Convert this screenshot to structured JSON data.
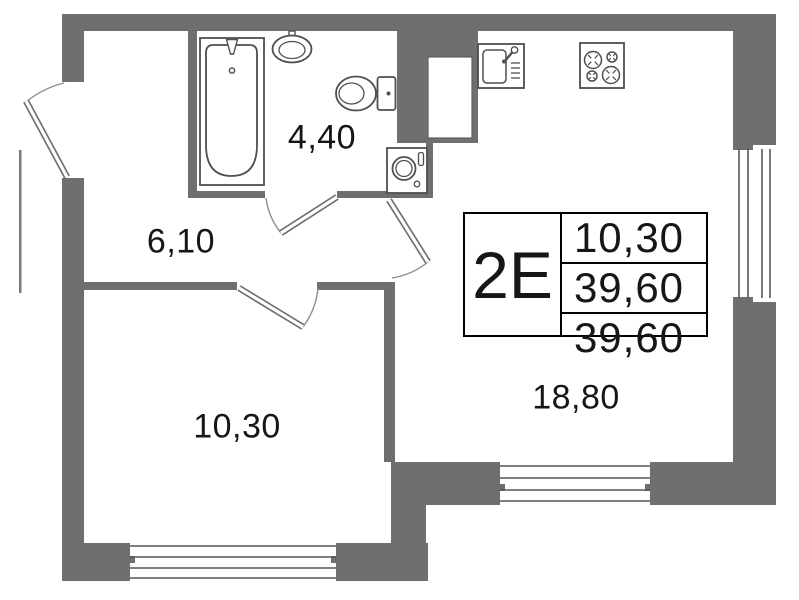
{
  "rooms": {
    "bathroom": {
      "area": "4,40"
    },
    "hallway": {
      "area": "6,10"
    },
    "bedroom": {
      "area": "10,30"
    },
    "living_kitchen": {
      "area": "18,80"
    }
  },
  "info_table": {
    "unit_type": "2E",
    "values": [
      "10,30",
      "39,60",
      "39,60"
    ]
  },
  "fixtures": {
    "bathtub": "bathtub-icon",
    "bathroom_sink": "sink-icon",
    "toilet": "toilet-icon",
    "washing_machine": "washing-machine-icon",
    "kitchen_sink": "kitchen-sink-icon",
    "stove": "stove-icon",
    "ventilation_shaft": "ventilation-shaft"
  },
  "colors": {
    "wall": "#6f6f6f",
    "fixture_stroke": "#4f4f4f",
    "window_line": "#565656",
    "door_arc": "#8f8f8f",
    "text": "#161616"
  }
}
